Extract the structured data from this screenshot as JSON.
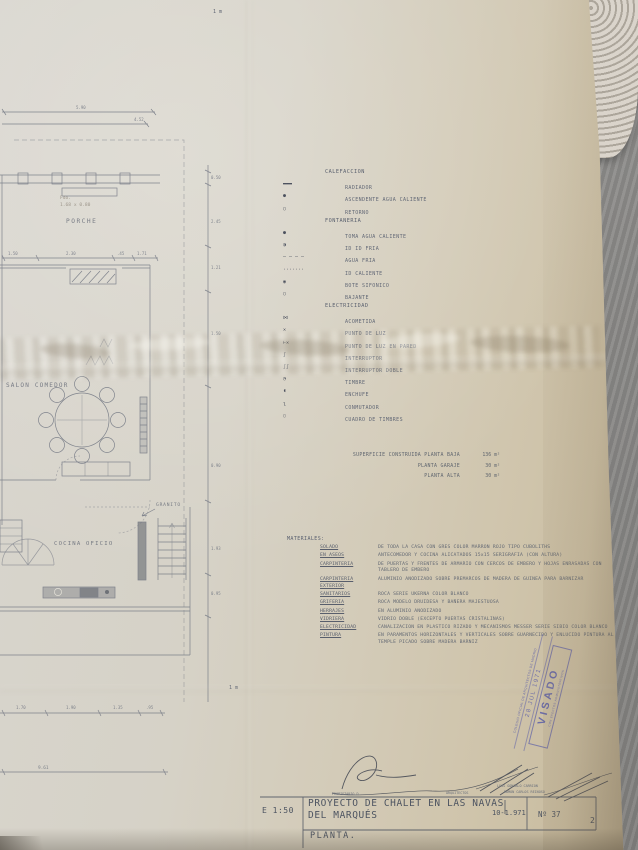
{
  "plan": {
    "labels": {
      "porche": "PORCHE",
      "salon": "SALON COMEDOR",
      "cocina": "COCINA OFICIO",
      "granito": "GRANITO",
      "note1": "Fdo.",
      "note2": "1.68 x 0.80",
      "scale_top": "1 m",
      "scale_bottom": "1 m"
    },
    "dims": {
      "top": [
        "5.90",
        "4.52"
      ],
      "mid": [
        "1.50",
        "2.30",
        ".45",
        "1.71"
      ],
      "right": [
        "0.50",
        "2.45",
        "1.21",
        "1.50",
        "0.90",
        "1.93",
        "0.95"
      ],
      "bottom": [
        "1.70",
        "1.90",
        "1.35",
        ".95"
      ],
      "total": "9.61"
    }
  },
  "legend": {
    "sections": [
      {
        "title": "CALEFACCION",
        "items": [
          {
            "symbol": "▬▬▬",
            "label": "RADIADOR"
          },
          {
            "symbol": "●",
            "label": "ASCENDENTE AGUA CALIENTE"
          },
          {
            "symbol": "○",
            "label": "RETORNO"
          }
        ]
      },
      {
        "title": "FONTANERIA",
        "items": [
          {
            "symbol": "●",
            "label": "TOMA AGUA CALIENTE"
          },
          {
            "symbol": "◑",
            "label": "ID    ID    FRIA"
          },
          {
            "symbol": "— — — —",
            "label": "AGUA FRIA"
          },
          {
            "symbol": "·······",
            "label": "ID  CALIENTE"
          },
          {
            "symbol": "◉",
            "label": "BOTE SIFONICO"
          },
          {
            "symbol": "○",
            "label": "BAJANTE"
          }
        ]
      },
      {
        "title": "ELECTRICIDAD",
        "items": [
          {
            "symbol": "⋈",
            "label": "ACOMETIDA"
          },
          {
            "symbol": "✕",
            "label": "PUNTO DE LUZ"
          },
          {
            "symbol": "⊢✕",
            "label": "PUNTO DE LUZ EN PARED"
          },
          {
            "symbol": "ʃ",
            "label": "INTERRUPTOR"
          },
          {
            "symbol": "ʃʃ",
            "label": "INTERRUPTOR DOBLE"
          },
          {
            "symbol": "◔",
            "label": "TIMBRE"
          },
          {
            "symbol": "◖",
            "label": "ENCHUFE"
          },
          {
            "symbol": "ʅ",
            "label": "CONMUTADOR"
          },
          {
            "symbol": "▯",
            "label": "CUADRO DE TIMBRES"
          }
        ]
      }
    ]
  },
  "areas": {
    "rows": [
      {
        "label": "SUPERFICIE CONSTRUIDA PLANTA BAJA",
        "value": "136 m²"
      },
      {
        "label": "PLANTA GARAJE",
        "value": "30 m²"
      },
      {
        "label": "PLANTA ALTA",
        "value": "30 m²"
      }
    ]
  },
  "materials": {
    "title": "MATERIALES:",
    "rows": [
      {
        "term": "SOLADO",
        "desc": "DE TODA LA CASA CON GRES COLOR MARRON ROJO TIPO CUBOLITHS"
      },
      {
        "term": "EN ASEOS",
        "desc": "ANTECOMEDOR Y COCINA ALICATADOS 15x15 SERIGRAFIA (CON ALTURA)"
      },
      {
        "term": "CARPINTERIA",
        "desc": "DE PUERTAS Y FRENTES DE ARMARIO CON CERCOS DE EMBERO Y HOJAS ENRASADAS CON TABLERO DE EMBERO"
      },
      {
        "term": "CARPINTERIA EXTERIOR",
        "desc": "ALUMINIO ANODIZADO SOBRE PREMARCOS DE MADERA DE GUINEA PARA BARNIZAR"
      },
      {
        "term": "SANITARIOS",
        "desc": "ROCA SERIE UKERNA COLOR BLANCO"
      },
      {
        "term": "GRIFERIA",
        "desc": "ROCA MODELO DRUIDESA Y BAÑERA MAJESTUOSA"
      },
      {
        "term": "HERRAJES",
        "desc": "EN ALUMINIO ANODIZADO"
      },
      {
        "term": "VIDRIERA",
        "desc": "VIDRIO DOBLE (EXCEPTO PUERTAS CRISTALINAS)"
      },
      {
        "term": "ELECTRICIDAD",
        "desc": "CANALIZACION EN PLASTICO RIZADO Y MECANISMOS MESSER SERIE SIBIO COLOR BLANCO"
      },
      {
        "term": "PINTURA",
        "desc": "EN PARAMENTOS HORIZONTALES Y VERTICALES SOBRE GUARNECIDO Y ENLUCIDO PINTURA AL TEMPLE PICADO SOBRE MADERA BARNIZ"
      }
    ]
  },
  "stamp": {
    "line1": "COLEGIO OFICIAL DE ARQUITECTOS DE MADRID",
    "date": "28 JUL 1971",
    "big": "VISADO",
    "line2": "CON EFECTOS ADMINISTRATIVOS"
  },
  "credits": {
    "propietario_label": "PROPIETARIO D.",
    "arquitectos_label": "ARQUITECTOS",
    "architects": [
      "LUIS GONZALO CARRION",
      "RAMON CARLOS REINOSO"
    ]
  },
  "title_block": {
    "scale": "E 1:50",
    "project_line1": "PROYECTO DE CHALET EN LAS NAVAS",
    "project_line2": "DEL MARQUÉS",
    "plan": "PLANTA.",
    "date": "10-1.971",
    "number": "Nº 37",
    "sheet": "2"
  }
}
